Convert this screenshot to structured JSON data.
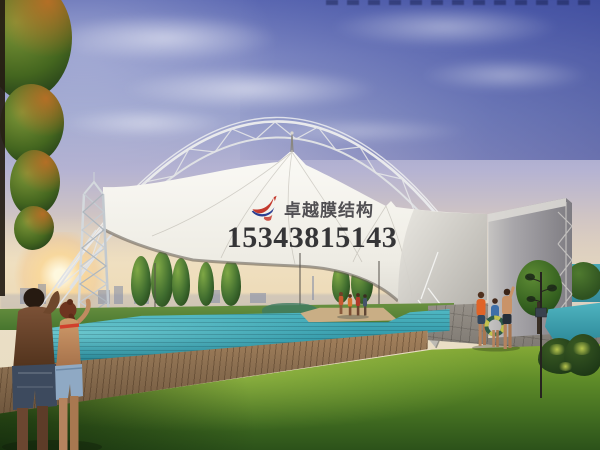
{
  "watermark": {
    "brand_text": "卓越膜结构",
    "phone_number": "15343815143",
    "logo_icon": "swoosh-bird-icon",
    "text_color": "#232128",
    "logo_red": "#c43a2e",
    "logo_blue": "#2c3f92"
  },
  "scene": {
    "subject": "tensile membrane canopy with steel arch truss over an outdoor swimming pool at dusk",
    "colors": {
      "sky_top": "#5b68b2",
      "sky_mid": "#b5b3d2",
      "horizon_haze": "#eadfc6",
      "sunset_glow": "#fbd692",
      "membrane_white": "#f2f0ea",
      "membrane_shade": "#aba8a2",
      "steel_truss": "#e9eaec",
      "anchor_wall": "#a8a6aa",
      "pool_teal": "#2f95a6",
      "pool_bright": "#96e8e8",
      "deck_wood": "#8a6e50",
      "pavement_gray": "#99938b",
      "grass_light": "#8fb23a",
      "grass_dark": "#2c521a",
      "tree_green": "#3e6b2e"
    }
  }
}
